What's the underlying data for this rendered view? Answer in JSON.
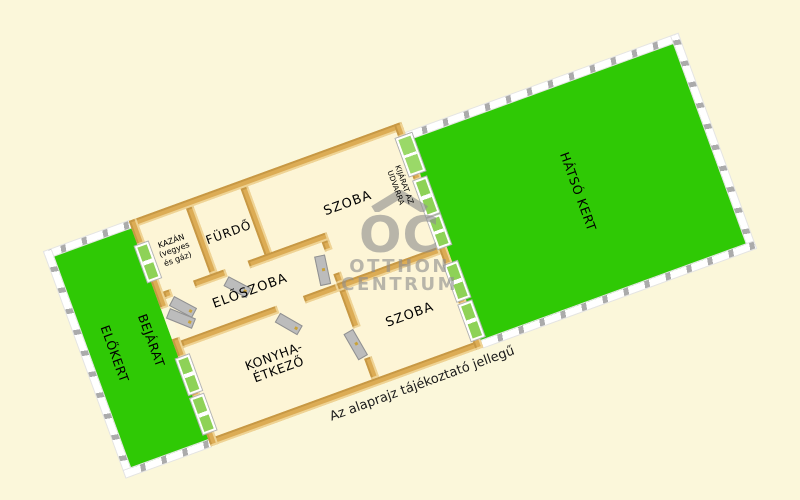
{
  "disclaimer": "Az alaprajz tájékoztató jellegű",
  "watermark": {
    "initials": "OC",
    "line1": "OTTHON",
    "line2": "CENTRUM"
  },
  "gardens": {
    "front": "ELŐKERT",
    "entrance": "BEJÁRAT",
    "back": "HÁTSÓ KERT"
  },
  "rooms": {
    "boiler": {
      "line1": "KAZÁN",
      "line2": "(vegyes",
      "line3": "és gáz)"
    },
    "bathroom": "FÜRDŐ",
    "room_top": "SZOBA",
    "hallway": "ELŐSZOBA",
    "kitchen": {
      "line1": "KONYHA-",
      "line2": "ÉTKEZŐ"
    },
    "room_bottom": "SZOBA",
    "exit": {
      "line1": "KIJÁRAT AZ",
      "line2": "UDVARRA"
    }
  },
  "colors": {
    "background": "#fbf7da",
    "floor": "#fdf5d6",
    "wall": "#dcac55",
    "grass": "#2fc905",
    "fence_white": "#ffffff",
    "fence_post": "#ababab",
    "door_gray": "#bcbcbc",
    "window_green": "#8ed257",
    "watermark_gray": "#8f8f8f"
  }
}
